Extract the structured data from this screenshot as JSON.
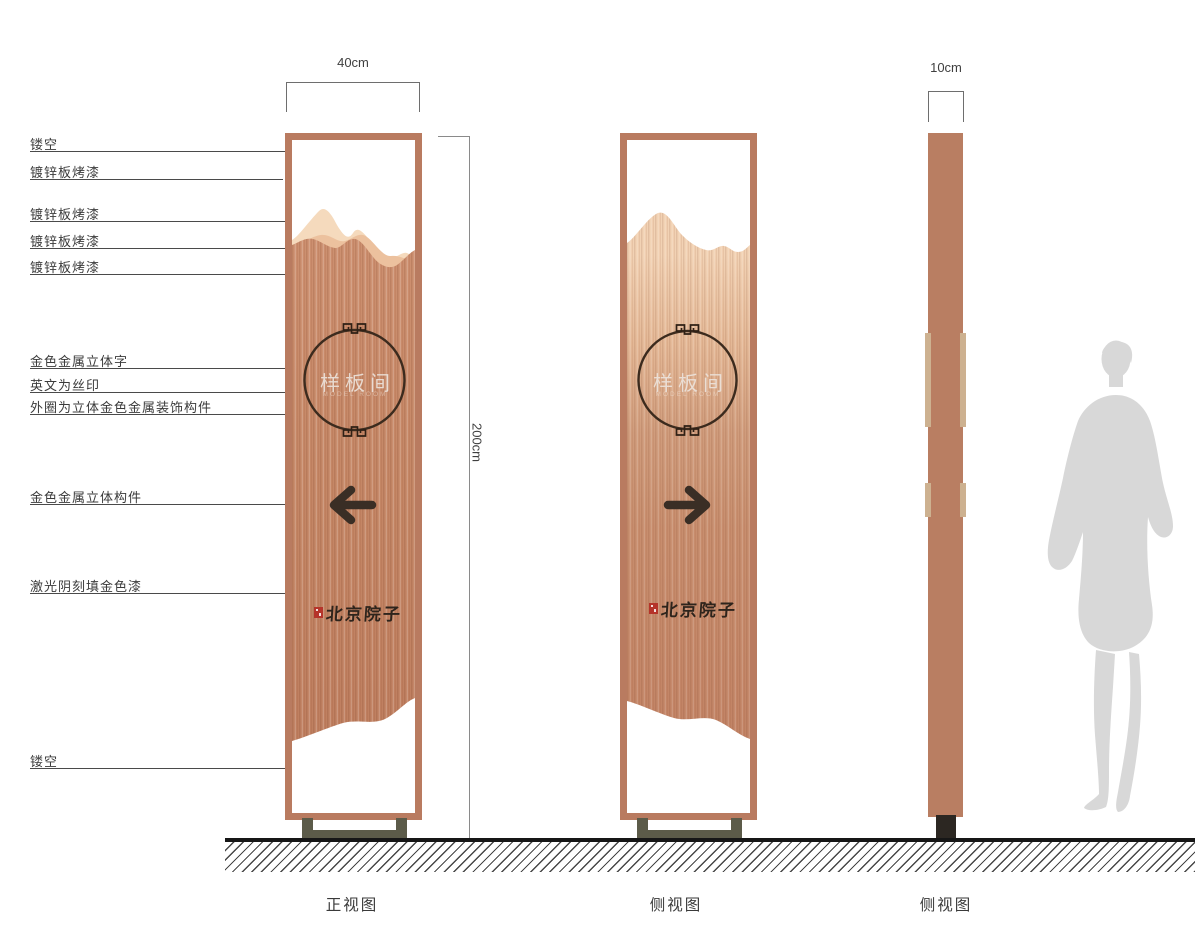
{
  "drawing": {
    "labels": [
      {
        "text": "镂空"
      },
      {
        "text": "镀锌板烤漆"
      },
      {
        "text": "镀锌板烤漆"
      },
      {
        "text": "镀锌板烤漆"
      },
      {
        "text": "镀锌板烤漆"
      },
      {
        "text": "金色金属立体字"
      },
      {
        "text": "英文为丝印"
      },
      {
        "text": "外圈为立体金色金属装饰构件"
      },
      {
        "text": "金色金属立体构件"
      },
      {
        "text": "激光阴刻填金色漆"
      },
      {
        "text": "镂空"
      }
    ],
    "dimensions": {
      "front_width": "40cm",
      "height": "200cm",
      "side_depth": "10cm"
    },
    "captions": {
      "front": "正视图",
      "side1": "侧视图",
      "side2": "侧视图"
    },
    "sign": {
      "room_name": "样板间",
      "room_name_en": "MODEL ROOM",
      "brand_logo": "北京院子"
    },
    "colors": {
      "frame_copper": "#b97b60",
      "body_copper": "#c78b6b",
      "mountain_light": "#f5dabd",
      "mountain_mid": "#ecc19e",
      "base_olive": "#5c5b49",
      "side_base_dark": "#2c2722",
      "seal_red": "#b5342a",
      "silhouette_gray": "#d8d8d8"
    }
  }
}
